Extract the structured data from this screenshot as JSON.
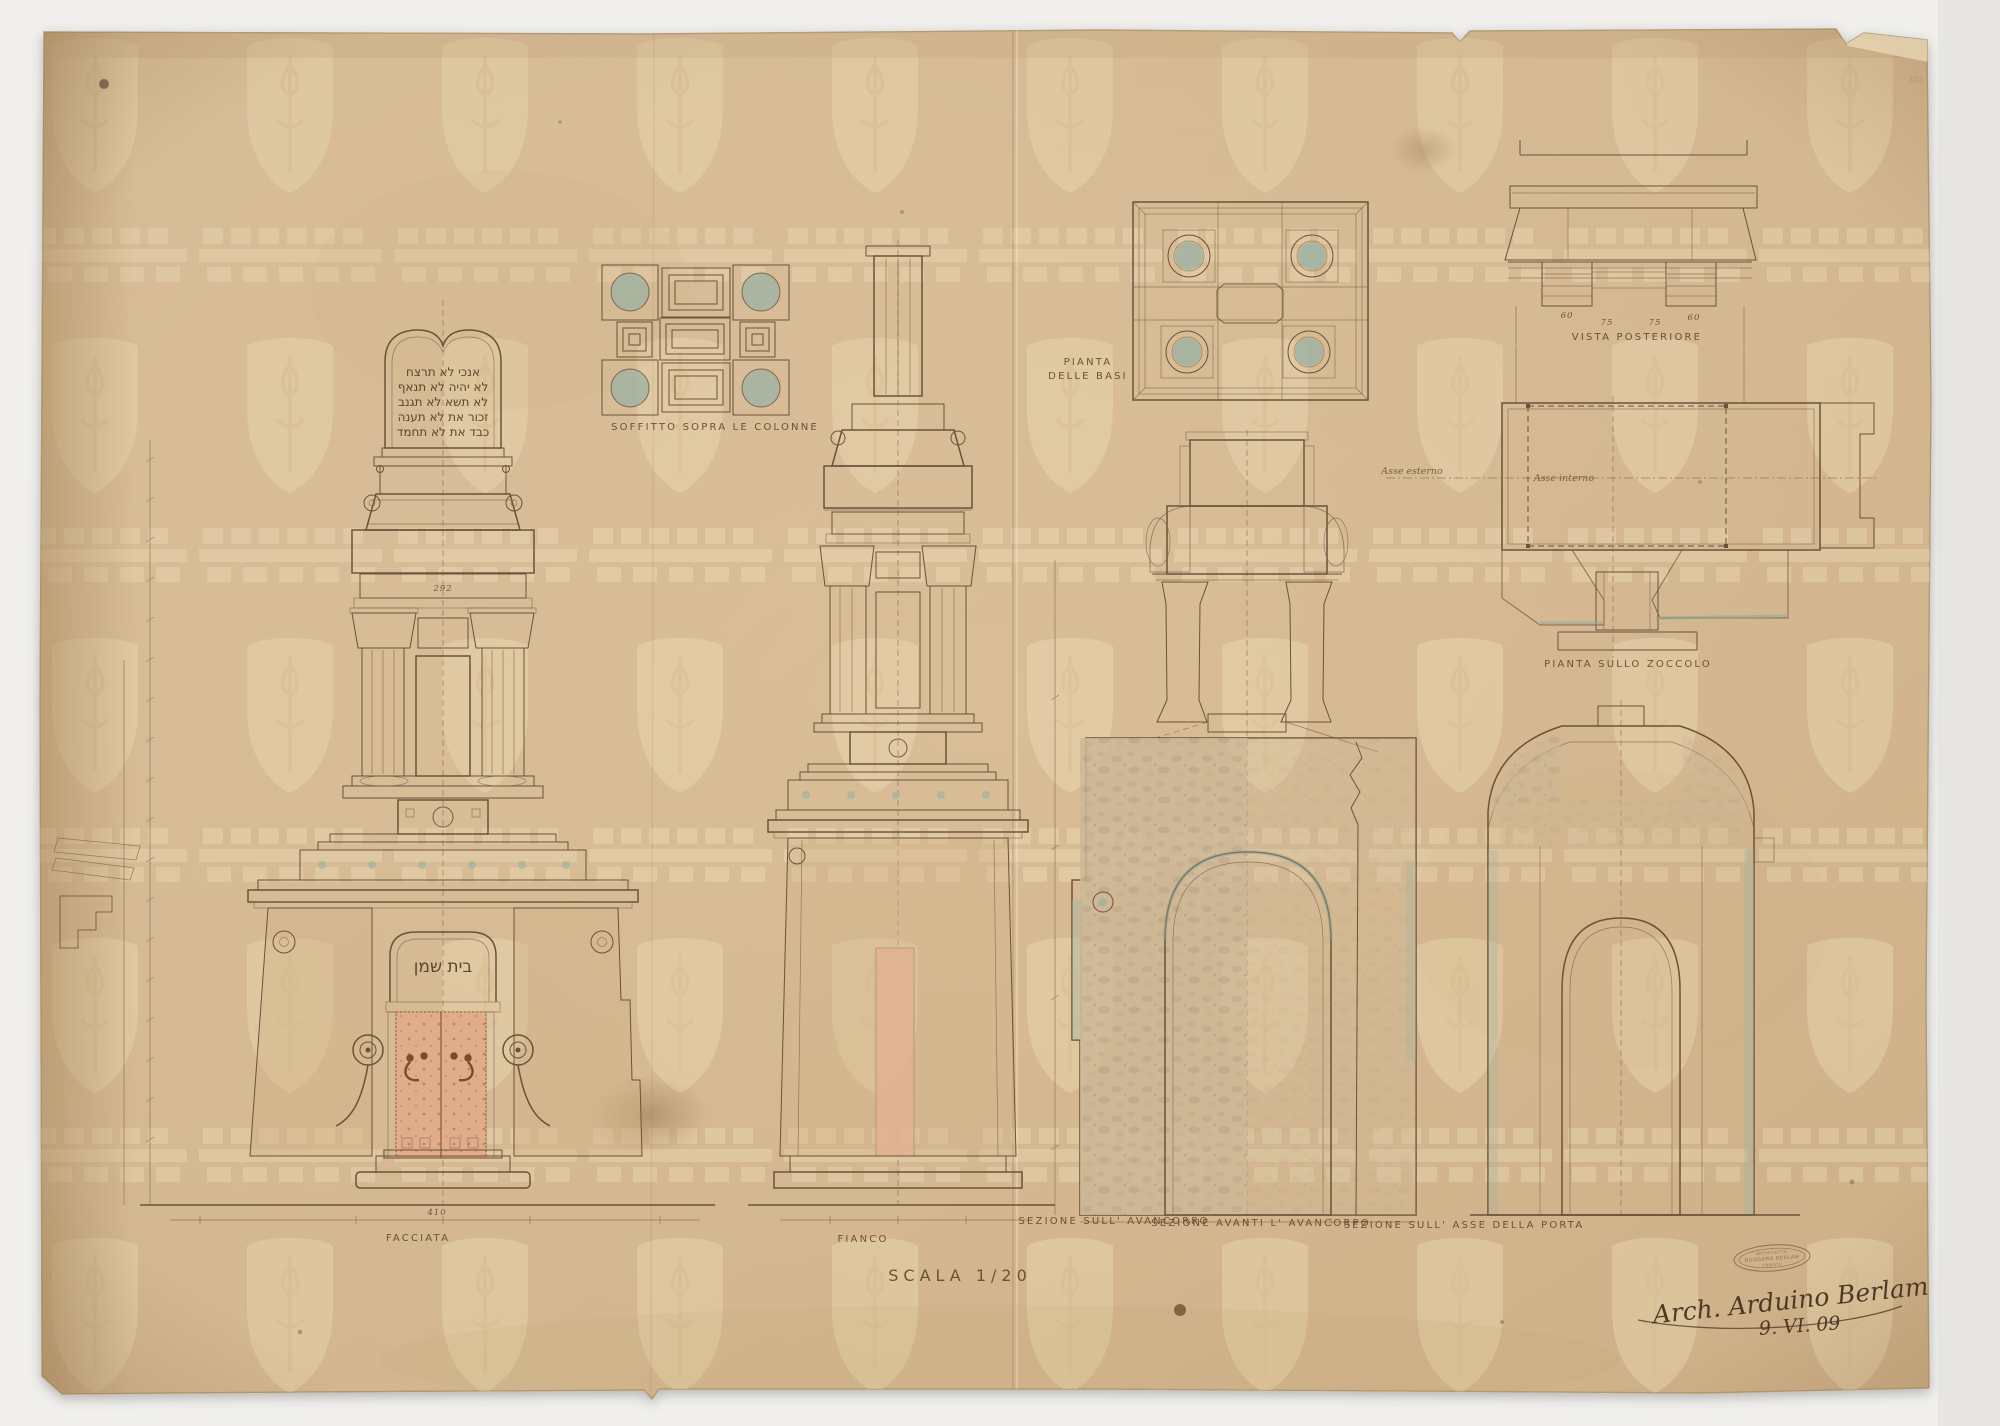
{
  "sheet": {
    "scale_label": "SCALA 1/20",
    "signature_name": "Arch. Arduino Berlam",
    "signature_date": "9. VI. 09",
    "stamp": {
      "line1": "ARCHITETTO",
      "line2": "RUGGERO BERLAM",
      "line3": "TRIESTE"
    },
    "corner_mark": "202"
  },
  "views": {
    "facciata": {
      "label": "FACCIATA",
      "base_dim": "410",
      "fascia_dim": "292",
      "lintel_text": "בית שמן",
      "tablet_lines": [
        "אנכי  לא תרצח",
        "לא יהיה  לא תנאף",
        "לא תשא  לא תגנב",
        "זכור את  לא תענה",
        "כבד את  לא תחמד"
      ]
    },
    "soffitto": {
      "label": "SOFFITTO SOPRA LE COLONNE"
    },
    "fianco": {
      "label": "FIANCO"
    },
    "pianta_basi": {
      "label_line1": "PIANTA",
      "label_line2": "DELLE BASI"
    },
    "vista_posteriore": {
      "label": "VISTA POSTERIORE",
      "dims": [
        "60",
        "75",
        "75",
        "60"
      ]
    },
    "pianta_zoccolo": {
      "label": "PIANTA SULLO ZOCCOLO",
      "axis_outer": "Asse esterno",
      "axis_inner": "Asse interno"
    },
    "sezione_avancorpo": {
      "label": "SEZIONE SULL' AVANCORPO"
    },
    "sezione_avanti": {
      "label": "SEZIONE AVANTI L' AVANCORPO"
    },
    "sezione_porta": {
      "label": "SEZIONE SULL' ASSE DELLA PORTA"
    }
  },
  "colors": {
    "background": "#f0efec",
    "paper": "#d9bd97",
    "paper_edge": "#b49a72",
    "ink": "#6b523a",
    "watermark": "#ecd9b2",
    "teal_accent": "#9fb3a3",
    "door_salmon": "#e0ac89",
    "pink_strip": "#e2b294",
    "marble": "#cdb795",
    "stain": "#8d6a42"
  }
}
